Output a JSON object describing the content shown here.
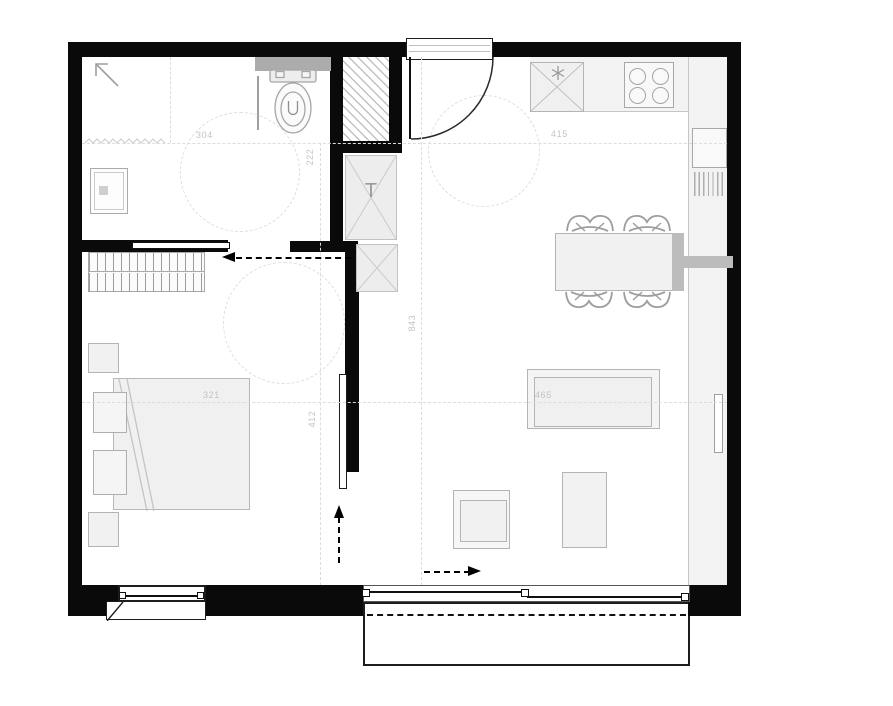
{
  "plan": {
    "type": "apartment-floor-plan",
    "colors": {
      "wall": "#0a0a0a",
      "furniture_outline": "#b4b4b4",
      "furniture_fill": "#f1f1f1",
      "counter_fill": "#f3f3f3",
      "dashed_guide": "#dcdcdc",
      "dimension_label": "#c3c3c3",
      "arrow": "#000000",
      "cistern_fill": "#acacac"
    },
    "labels": {
      "bathroom_width": "304",
      "bathroom_depth": "222",
      "kitchen_width": "415",
      "bedroom_width": "321",
      "bedroom_depth": "412",
      "living_length": "843",
      "sofa_width": "465",
      "tech_shaft": "T"
    },
    "rooms": [
      {
        "name": "bathroom",
        "furniture": [
          "toilet",
          "cistern",
          "shower-tray",
          "clearance-circle"
        ]
      },
      {
        "name": "hall",
        "furniture": [
          "technical-shaft",
          "tech-cabinet",
          "cabinet",
          "entrance-door",
          "clearance-circle"
        ]
      },
      {
        "name": "bedroom",
        "furniture": [
          "wardrobe",
          "double-bed",
          "pillow",
          "pillow",
          "nightstand",
          "nightstand",
          "clearance-circle",
          "window"
        ]
      },
      {
        "name": "kitchen-living",
        "furniture": [
          "fridge-freezer",
          "cooktop-4-burner",
          "kitchen-counter",
          "sink-cabinet",
          "radiator",
          "dining-table",
          "chair",
          "chair",
          "chair",
          "chair",
          "sofa",
          "armchair",
          "coffee-table",
          "tv",
          "sliding-glass-door",
          "balcony"
        ]
      }
    ]
  }
}
